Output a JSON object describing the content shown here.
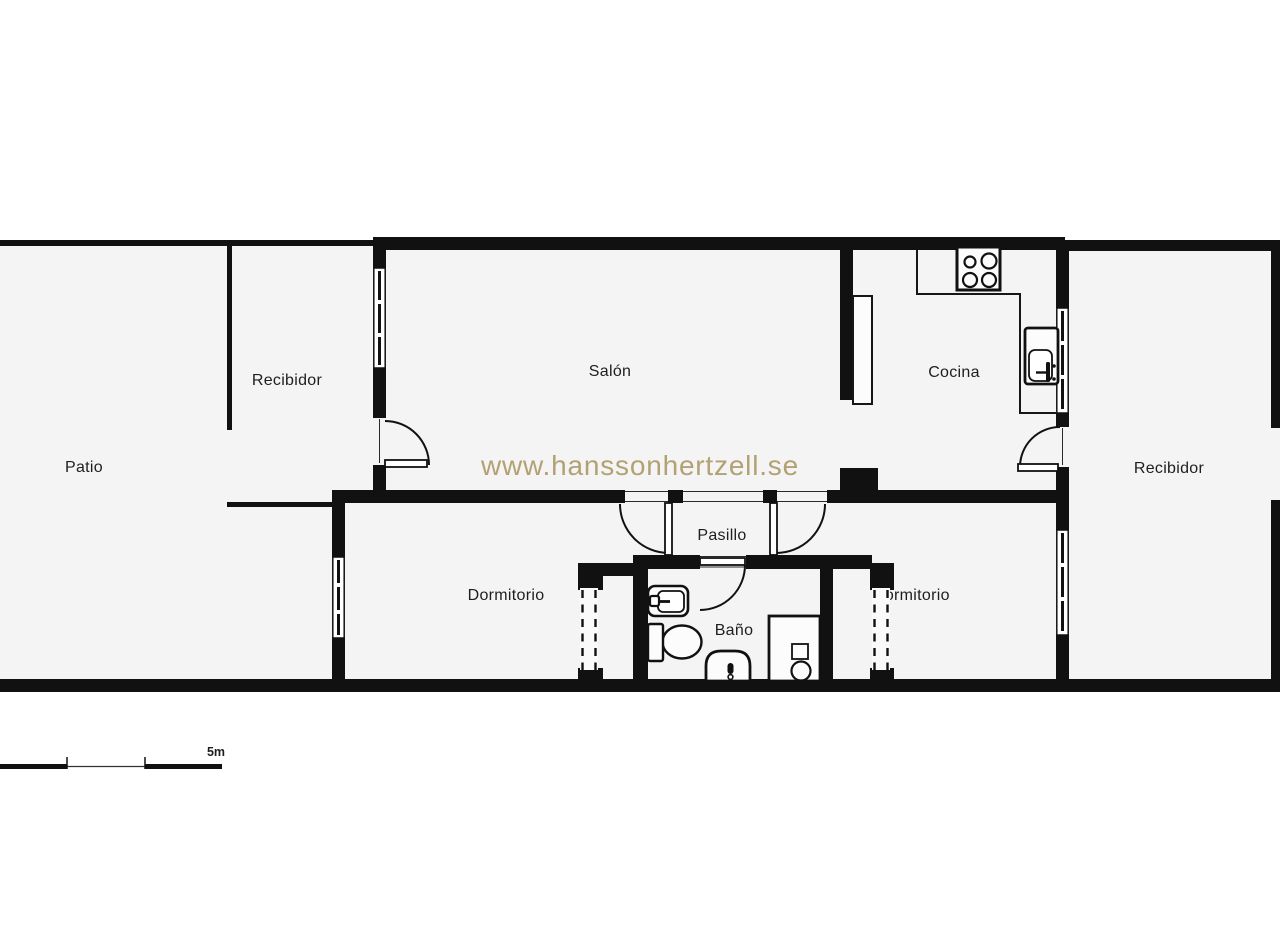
{
  "title": "Apartment floor plan",
  "watermark": {
    "text": "www.hanssonhertzell.se",
    "color": "#b2a173"
  },
  "scale_bar": {
    "label": "5m"
  },
  "colors": {
    "wall": "#111111",
    "floor": "#f4f4f4",
    "fixture_fill": "#fcfcfc",
    "label": "#1e1e1e",
    "watermark": "#b2a173",
    "background": "#ffffff"
  },
  "rooms": {
    "patio": {
      "label": "Patio"
    },
    "recibidor_left": {
      "label": "Recibidor"
    },
    "salon": {
      "label": "Salón"
    },
    "cocina": {
      "label": "Cocina"
    },
    "recibidor_right": {
      "label": "Recibidor"
    },
    "pasillo": {
      "label": "Pasillo"
    },
    "dormitorio_left": {
      "label": "Dormitorio"
    },
    "bano": {
      "label": "Baño"
    },
    "dormitorio_right": {
      "label": "Dormitorio"
    }
  },
  "icons": [
    "stove-icon",
    "kitchen-sink-icon",
    "refrigerator-icon",
    "washbasin-icon",
    "toilet-icon",
    "bidet-icon",
    "washing-machine-icon",
    "door-arc-icon",
    "window-icon",
    "sliding-wardrobe-door-icon",
    "scale-bar-icon"
  ]
}
